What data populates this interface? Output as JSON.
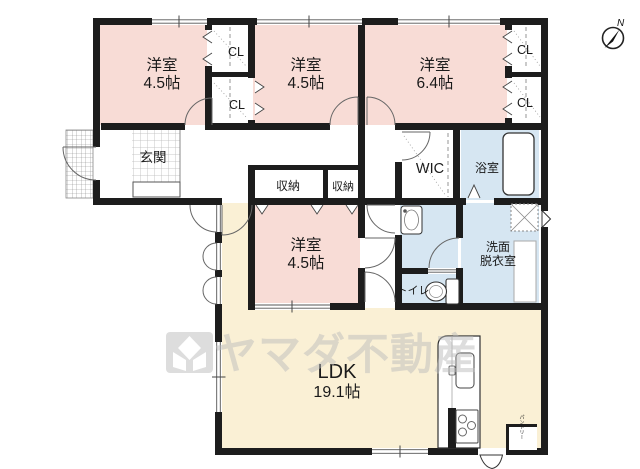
{
  "title": "floor-plan",
  "compass": {
    "north_label": "N"
  },
  "watermark": {
    "brand": "ヤマダ不動産"
  },
  "colors": {
    "wall": "#1d1d1d",
    "bedroom_pink": "#f8dcd6",
    "ldk_cream": "#faf0d5",
    "wet_blue": "#d6e6f2",
    "watermark_gray": "#bdbdbd"
  },
  "rooms": {
    "bedroom_top_left": {
      "label": "洋室",
      "size": "4.5帖"
    },
    "bedroom_top_middle": {
      "label": "洋室",
      "size": "4.5帖"
    },
    "bedroom_top_right": {
      "label": "洋室",
      "size": "6.4帖"
    },
    "bedroom_center": {
      "label": "洋室",
      "size": "4.5帖"
    },
    "ldk": {
      "label": "LDK",
      "size": "19.1帖"
    },
    "entrance": {
      "label": "玄関"
    },
    "wic": {
      "label": "WIC"
    },
    "bathroom": {
      "label": "浴室"
    },
    "washroom": {
      "label_line1": "洗面",
      "label_line2": "脱衣室"
    },
    "toilet": {
      "label": "トイレ"
    },
    "pantry": {
      "label": "パントリー"
    },
    "closet_top_a": {
      "label": "CL"
    },
    "closet_bottom_a": {
      "label": "CL"
    },
    "closet_top_b": {
      "label": "CL"
    },
    "closet_bottom_b": {
      "label": "CL"
    },
    "storage_1": {
      "label": "収納"
    },
    "storage_2": {
      "label": "収納"
    }
  }
}
